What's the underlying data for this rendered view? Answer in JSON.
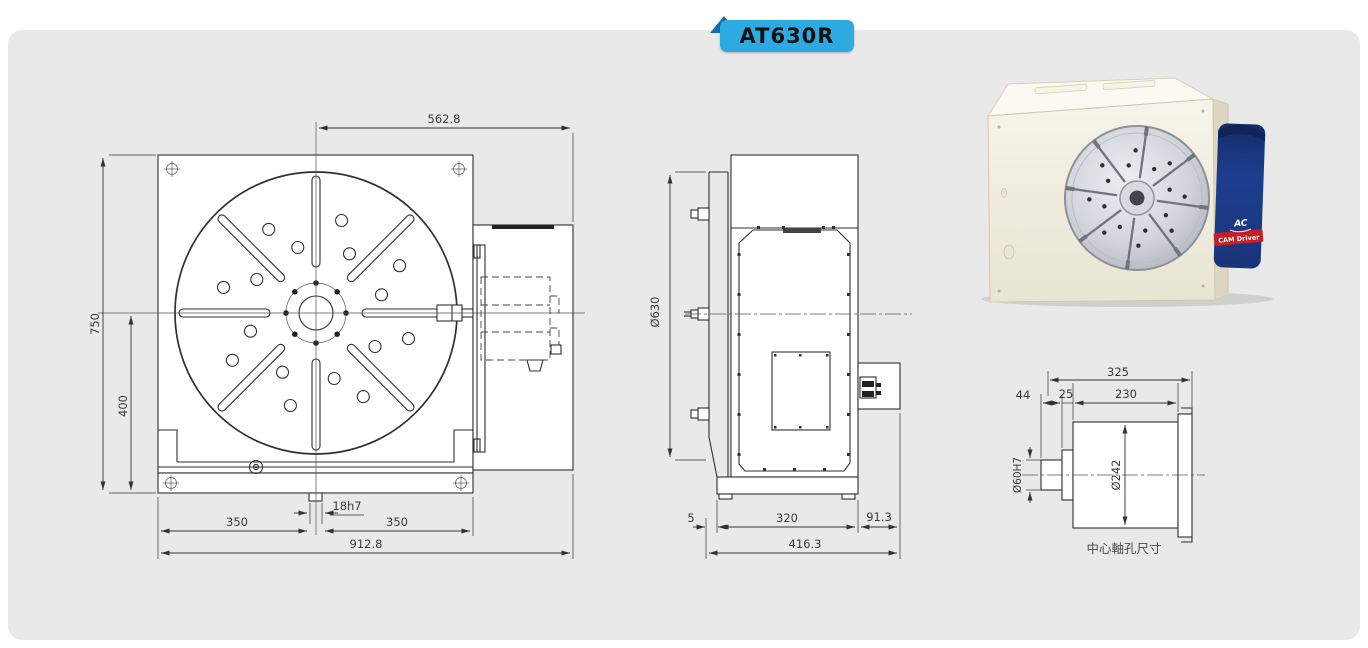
{
  "badge": {
    "label": "AT630R"
  },
  "front_view": {
    "dim_top_width": "562.8",
    "dim_height": "750",
    "dim_center_height": "400",
    "dim_bottom_left": "350",
    "dim_key_slot": "18h7",
    "dim_bottom_right": "350",
    "dim_total_width": "912.8"
  },
  "side_view": {
    "dim_table_diameter": "Ø630",
    "dim_overhang": "5",
    "dim_body_depth": "320",
    "dim_motor_depth": "91.3",
    "dim_total_depth": "416.3"
  },
  "shaft_detail": {
    "dim_total_length": "325",
    "dim_shaft_length": "44",
    "dim_step_length": "25",
    "dim_body_length": "230",
    "dim_bore_diameter": "Ø60H7",
    "dim_flange_diameter": "Ø242",
    "caption": "中心軸孔尺寸"
  },
  "photo": {
    "logo_text": "AC",
    "driver_badge": "CAM Driver"
  },
  "colors": {
    "badge_bg": "#2babe2",
    "badge_fold": "#1a6ab3",
    "panel_bg": "#e9e9e9",
    "line": "#2f2f2f",
    "driver_blue": "#1d3e8f",
    "driver_red": "#c51f26",
    "product_body": "#f2efe3"
  }
}
